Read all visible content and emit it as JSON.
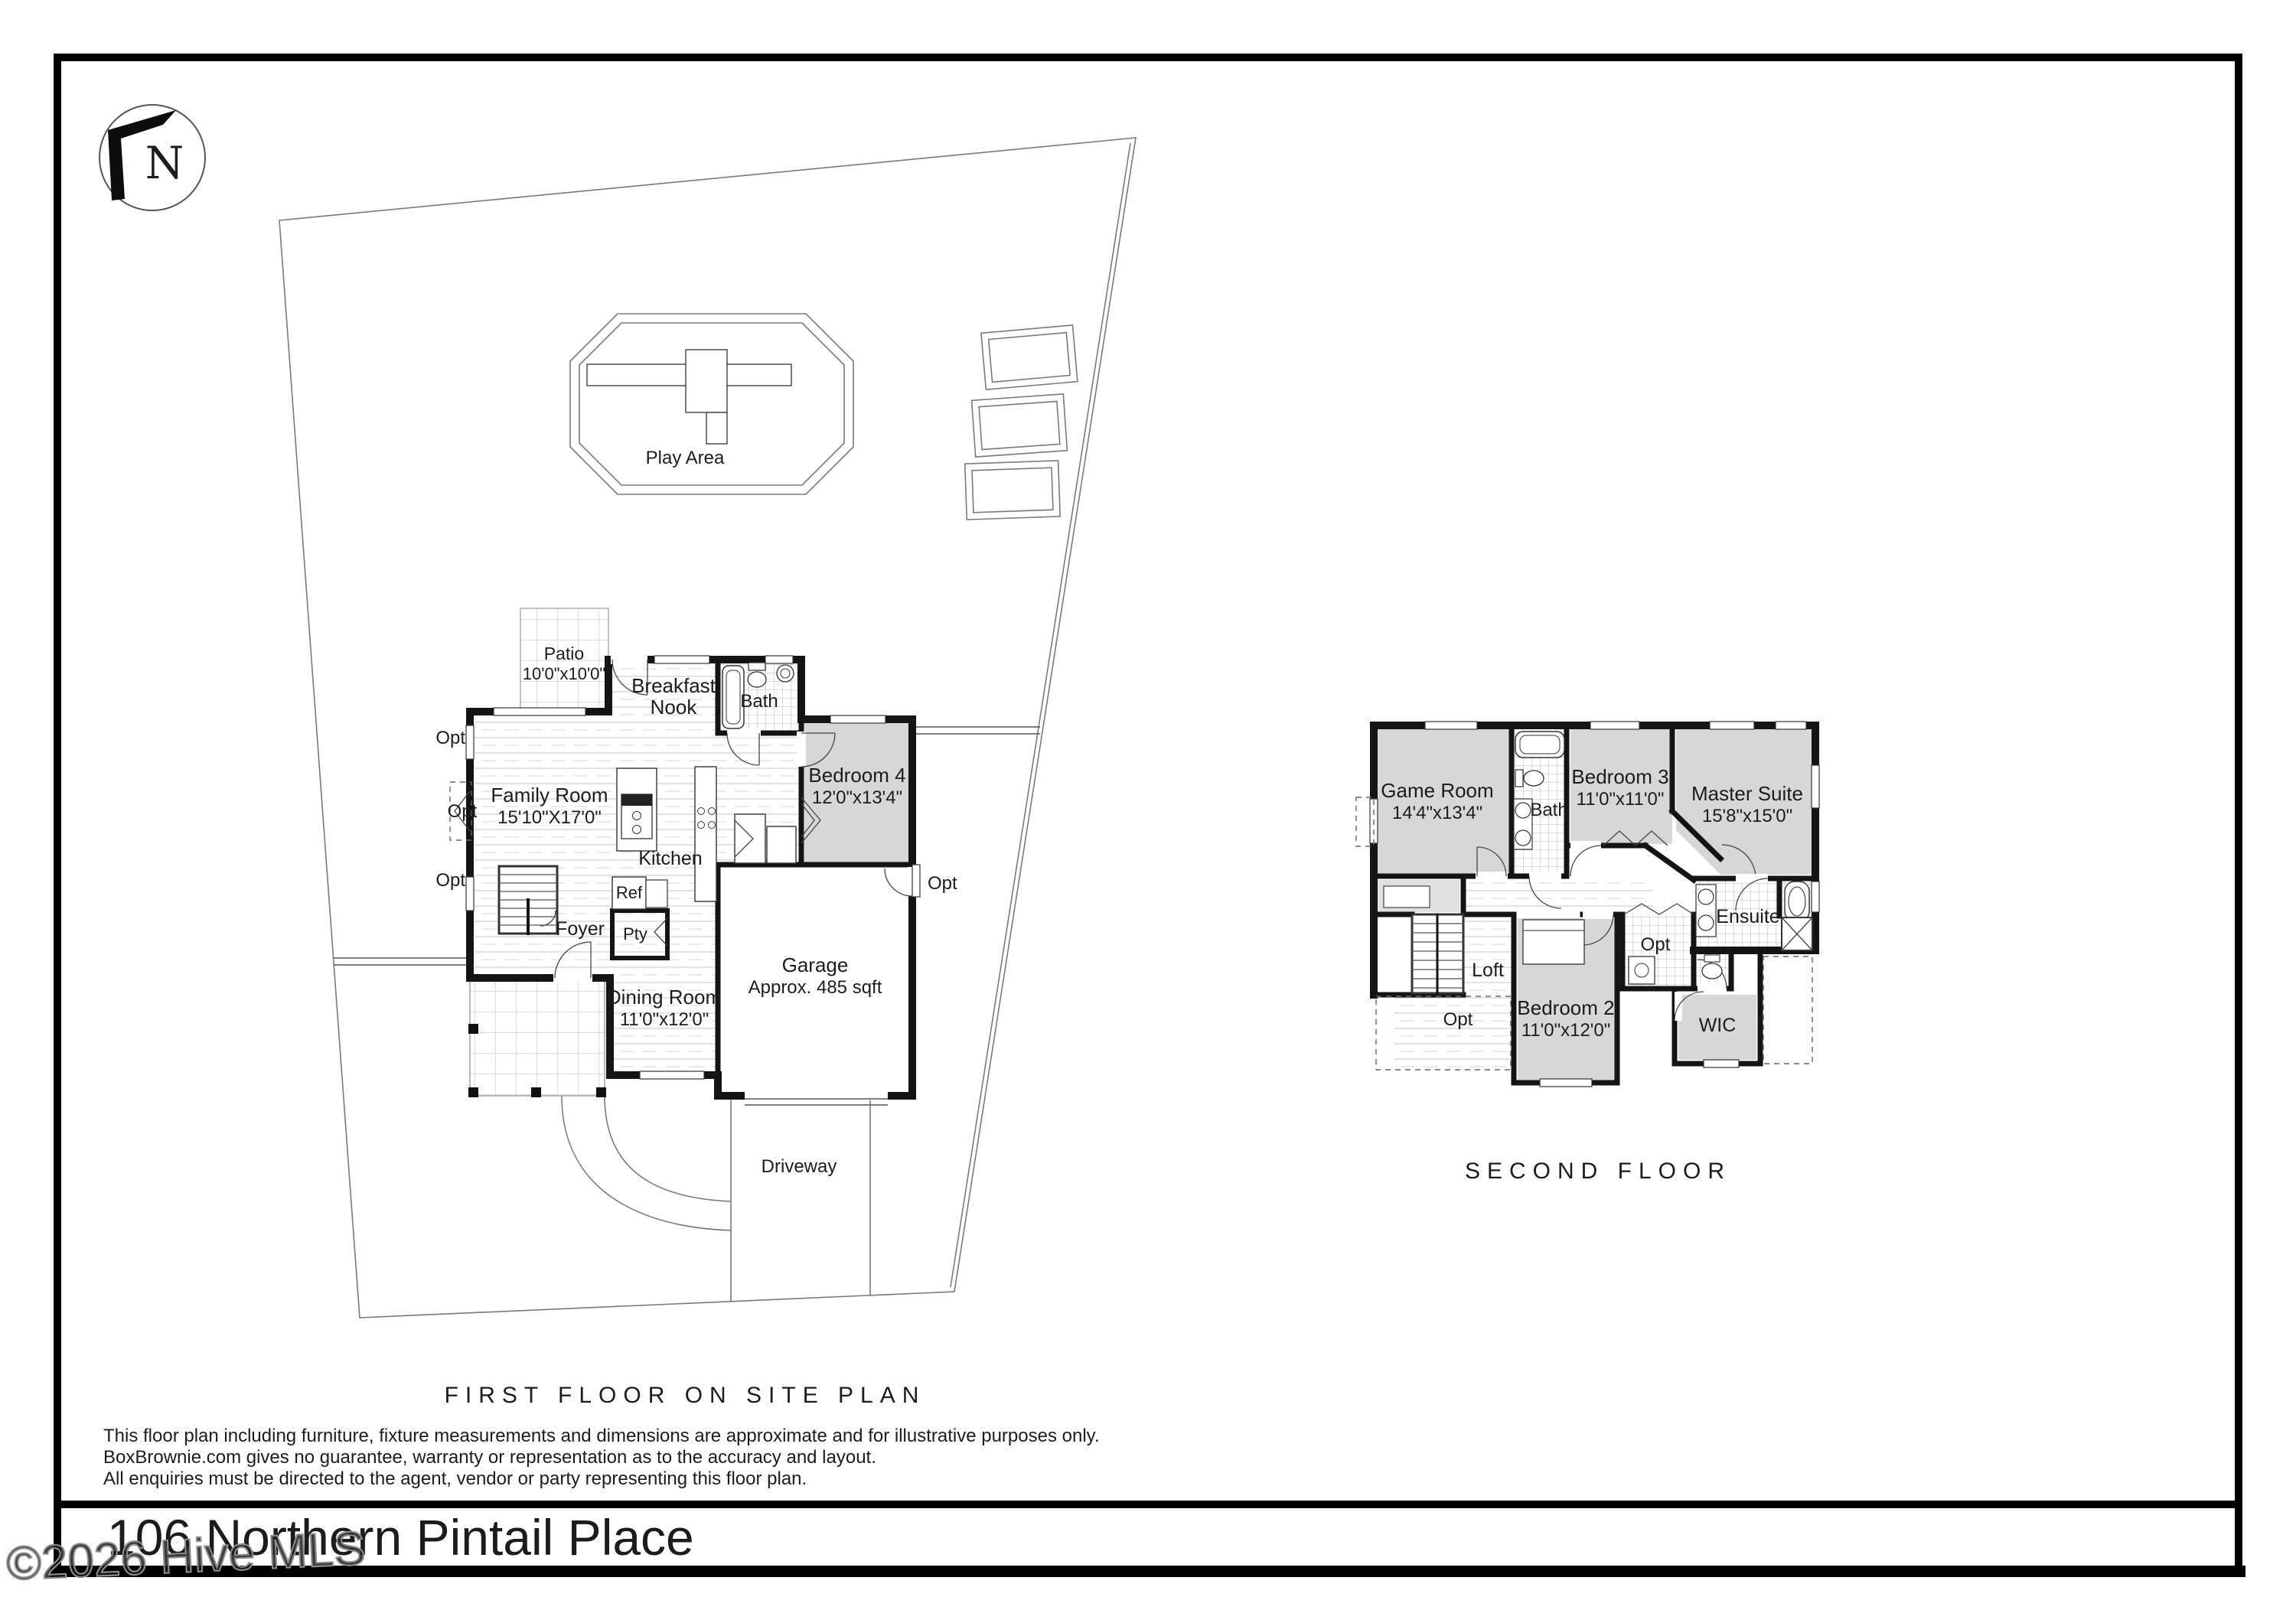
{
  "page": {
    "compass_letter": "N",
    "title": "106 Northern Pintail Place",
    "watermark": "©2026 Hive MLS",
    "captions": {
      "first_floor": "FIRST FLOOR ON SITE PLAN",
      "second_floor": "SECOND FLOOR"
    },
    "disclaimer": {
      "line1": "This floor plan including furniture, fixture measurements and dimensions are approximate and for illustrative purposes only.",
      "line2": "BoxBrownie.com gives no guarantee, warranty or representation as to the accuracy and layout.",
      "line3": "All enquiries must be directed to the agent, vendor or party representing this floor plan."
    }
  },
  "site": {
    "play_area": "Play Area",
    "driveway": "Driveway"
  },
  "labels": {
    "opt": "Opt"
  },
  "first_floor": {
    "patio": {
      "name": "Patio",
      "dims": "10'0\"x10'0\""
    },
    "breakfast_nook": {
      "line1": "Breakfast",
      "line2": "Nook"
    },
    "bath": "Bath",
    "bedroom4": {
      "name": "Bedroom 4",
      "dims": "12'0\"x13'4\""
    },
    "family_room": {
      "name": "Family Room",
      "dims": "15'10\"X17'0\""
    },
    "kitchen": "Kitchen",
    "ref": "Ref",
    "pantry": "Pty",
    "foyer": "Foyer",
    "dining_room": {
      "name": "Dining Room",
      "dims": "11'0\"x12'0\""
    },
    "garage": {
      "name": "Garage",
      "dims": "Approx. 485 sqft"
    }
  },
  "second_floor": {
    "game_room": {
      "name": "Game Room",
      "dims": "14'4\"x13'4\""
    },
    "bath": "Bath",
    "bedroom3": {
      "name": "Bedroom 3",
      "dims": "11'0\"x11'0\""
    },
    "master_suite": {
      "name": "Master Suite",
      "dims": "15'8\"x15'0\""
    },
    "loft": "Loft",
    "ensuite": "Ensuite",
    "bedroom2": {
      "name": "Bedroom 2",
      "dims": "11'0\"x12'0\""
    },
    "wic": "WIC"
  }
}
